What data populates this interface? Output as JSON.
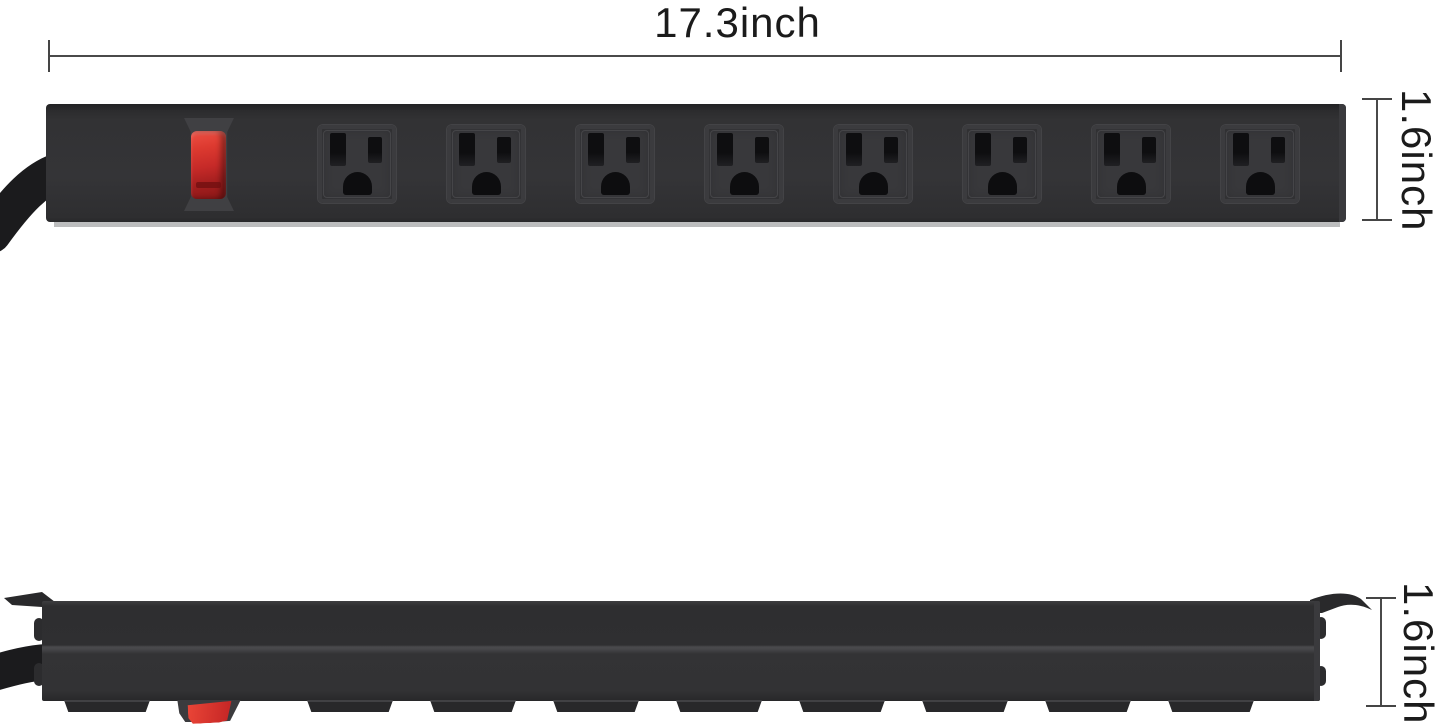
{
  "annotations": {
    "width_label": "17.3inch",
    "height_label_top_view": "1.6inch",
    "height_label_side_view": "1.6inch",
    "dimension_line_color": "#4a4a4a",
    "label_color": "#1b1b1b"
  },
  "product": {
    "description": "Black metal mountable power strip with red power switch, shown in front view (top) and side profile view (bottom)",
    "outlet_count": 8,
    "visible_feet_count": 9,
    "colors": {
      "body": "#323234",
      "outlet_face": "#38383b",
      "slot": "#0e0e10",
      "switch_red": "#d23028",
      "cord": "#1b1b1d",
      "background": "#ffffff"
    }
  }
}
